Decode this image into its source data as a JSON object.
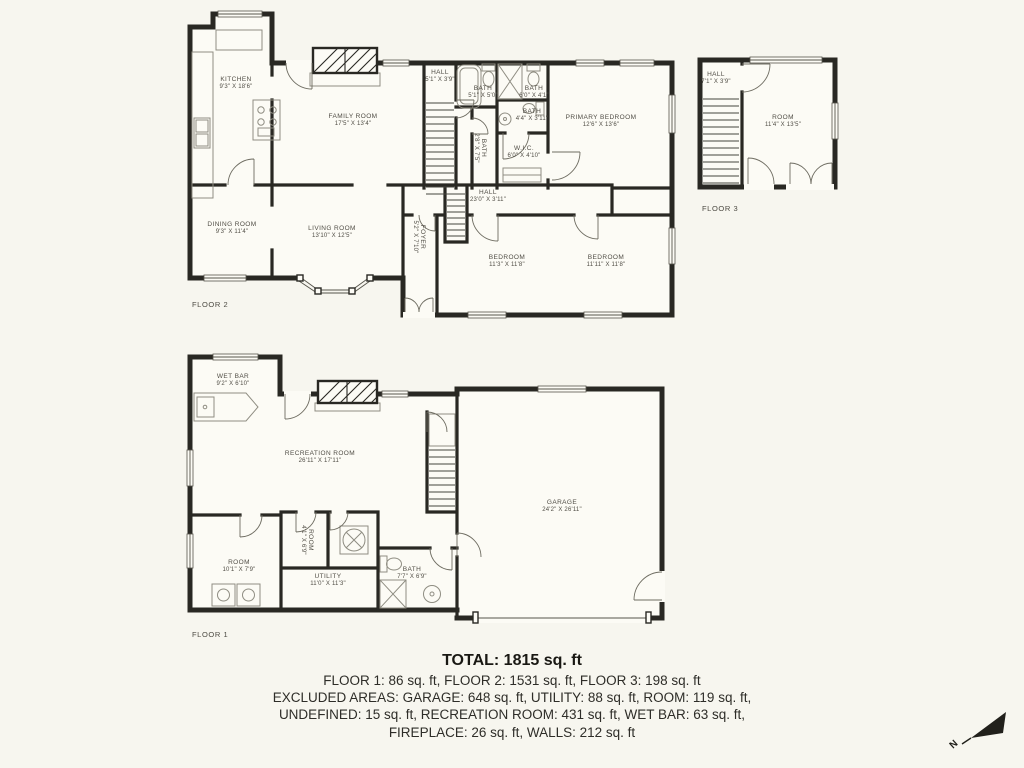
{
  "page": {
    "background": "#f7f6ef",
    "wall_color": "#292823",
    "label_color": "#504d45"
  },
  "floor2": {
    "tag": "FLOOR 2",
    "rooms": {
      "kitchen": {
        "name": "KITCHEN",
        "dims": "9'3\" X 18'6\""
      },
      "family": {
        "name": "FAMILY ROOM",
        "dims": "17'5\" X 13'4\""
      },
      "hall_top": {
        "name": "HALL",
        "dims": "5'1\" X 3'9\""
      },
      "bath1": {
        "name": "BATH",
        "dims": "5'1\" X 5'0\""
      },
      "bath2": {
        "name": "BATH",
        "dims": "6'0\" X 4'1\""
      },
      "bath3": {
        "name": "BATH",
        "dims": "4'4\" X 3'11\""
      },
      "bath4": {
        "name": "BATH",
        "dims": "2'8\" X 7'5\""
      },
      "primary": {
        "name": "PRIMARY BEDROOM",
        "dims": "12'6\" X 13'6\""
      },
      "wic": {
        "name": "W.I.C.",
        "dims": "6'0\" X 4'10\""
      },
      "hall_main": {
        "name": "HALL",
        "dims": "23'0\" X 3'11\""
      },
      "dining": {
        "name": "DINING ROOM",
        "dims": "9'3\" X 11'4\""
      },
      "living": {
        "name": "LIVING ROOM",
        "dims": "13'10\" X 12'5\""
      },
      "foyer": {
        "name": "FOYER",
        "dims": "5'2\" X 7'10\""
      },
      "bedroom1": {
        "name": "BEDROOM",
        "dims": "11'3\" X 11'8\""
      },
      "bedroom2": {
        "name": "BEDROOM",
        "dims": "11'11\" X 11'8\""
      }
    }
  },
  "floor3": {
    "tag": "FLOOR 3",
    "rooms": {
      "hall": {
        "name": "HALL",
        "dims": "7'1\" X 3'9\""
      },
      "room": {
        "name": "ROOM",
        "dims": "11'4\" X 13'5\""
      }
    }
  },
  "floor1": {
    "tag": "FLOOR 1",
    "rooms": {
      "wetbar": {
        "name": "WET BAR",
        "dims": "9'2\" X 6'10\""
      },
      "recreation": {
        "name": "RECREATION ROOM",
        "dims": "26'11\" X 17'11\""
      },
      "room1": {
        "name": "ROOM",
        "dims": "10'1\" X 7'9\""
      },
      "room2": {
        "name": "ROOM",
        "dims": "4'1\" X 6'9\""
      },
      "utility": {
        "name": "UTILITY",
        "dims": "11'0\" X 11'3\""
      },
      "bath": {
        "name": "BATH",
        "dims": "7'7\" X 6'9\""
      },
      "garage": {
        "name": "GARAGE",
        "dims": "24'2\" X 26'11\""
      }
    }
  },
  "summary": {
    "total": "TOTAL: 1815 sq. ft",
    "line1": "FLOOR 1: 86 sq. ft, FLOOR 2: 1531 sq. ft, FLOOR 3: 198 sq. ft",
    "line2": "EXCLUDED AREAS: GARAGE: 648 sq. ft, UTILITY: 88 sq. ft, ROOM: 119 sq. ft,",
    "line3": "UNDEFINED: 15 sq. ft, RECREATION ROOM: 431 sq. ft, WET BAR: 63 sq. ft,",
    "line4": "FIREPLACE: 26 sq. ft, WALLS: 212 sq. ft"
  },
  "compass": {
    "label": "N"
  }
}
